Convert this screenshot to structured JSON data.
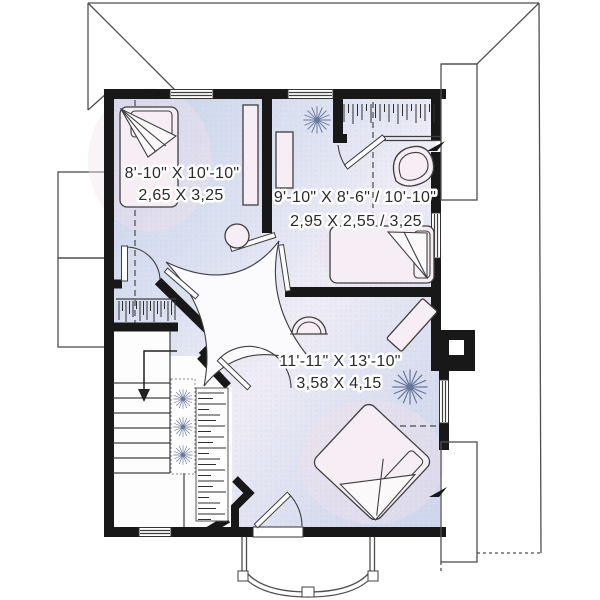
{
  "plan": {
    "type": "floor-plan-second-storey",
    "rooms": [
      {
        "id": "bedroom-left",
        "imperial": "8'-10\" X 10'-10\"",
        "metric": "2,65 X 3,25"
      },
      {
        "id": "bedroom-right",
        "imperial": "9'-10\" X 8'-6\" / 10'-10\"",
        "metric": "2,95 X 2,55 / 3,25"
      },
      {
        "id": "bedroom-master",
        "imperial": "11'-11\" X 13'-10\"",
        "metric": "3,58 X 4,15"
      }
    ],
    "colors": {
      "wall": "#181818",
      "interior_blue": "#c7d3eb",
      "interior_light": "#efecf6",
      "furniture": "#f6eef4",
      "label_text": "#2b2b2b",
      "sparkle": "#66779c"
    }
  }
}
